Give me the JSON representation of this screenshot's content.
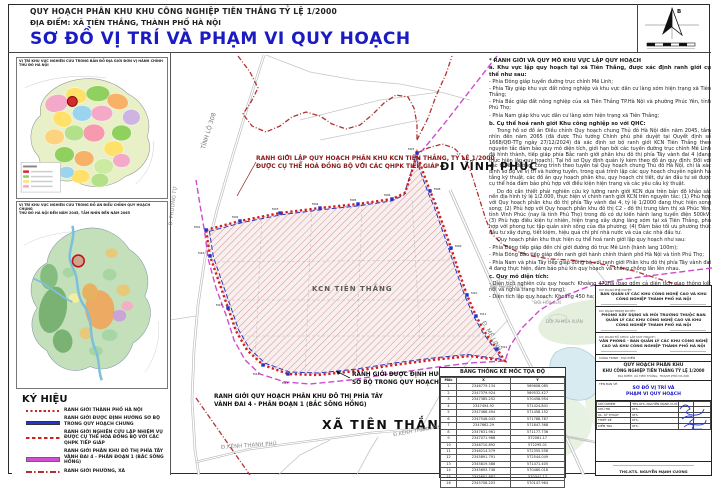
{
  "header": {
    "line1": "QUY HOẠCH PHÂN KHU KHU CÔNG NGHIỆP TIÊN THẮNG TỶ LỆ 1/2000",
    "line2": "ĐỊA ĐIỂM: XÃ TIÊN THẮNG, THÀNH PHỐ HÀ NỘI",
    "title": "SƠ ĐỒ VỊ TRÍ VÀ PHẠM VI QUY HOẠCH",
    "title_color": "#1b1bc4",
    "north_letter": "B"
  },
  "insets": {
    "map1_title_l1": "VỊ TRÍ KHU VỰC NGHIÊN CỨU TRONG BẢN ĐỒ ĐỊA GIỚI ĐƠN VỊ HÀNH CHÍNH",
    "map1_title_l2": "THỦ ĐÔ HÀ NỘI",
    "map2_title_l1": "VỊ TRÍ KHU VỰC NGHIÊN CỨU TRONG ĐỒ ÁN ĐIỀU CHỈNH QUY HOẠCH CHUNG",
    "map2_title_l2": "THỦ ĐÔ HÀ NỘI ĐẾN NĂM 2045, TẦM NHÌN ĐẾN NĂM 2065"
  },
  "legend": {
    "title": "KÝ HIỆU",
    "items": [
      {
        "label": "RANH GIỚI THÀNH PHỐ HÀ NỘI"
      },
      {
        "label": "RANH GIỚI ĐƯỢC ĐỊNH HƯỚNG SƠ BỘ TRONG QUY HOẠCH CHUNG"
      },
      {
        "label": "RANH GIỚI NGHIÊN CỨU LẬP NHIỆM VỤ ĐƯỢC CỤ THỂ HÓA ĐỒNG BỘ VỚI CÁC QHPK TIẾP GIÁP"
      },
      {
        "label": "RANH GIỚI PHÂN KHU ĐÔ THỊ PHÍA TÂY VÀNH ĐAI 4 - PHÂN ĐOẠN 1 (BẮC SÔNG HỒNG)"
      },
      {
        "label": "RANH GIỚI PHƯỜNG, XÃ"
      }
    ]
  },
  "map": {
    "site_label": "KCN TIÊN THẮNG",
    "labels": {
      "di_vinh_phuc": "ĐI VĨNH PHÚC",
      "xa_tien_thang": "XÃ TIÊN THẮNG",
      "tinh_lo_308": "TỈNH LỘ 308",
      "d_me_linh": "Đ. MÊ LINH",
      "d_kenh_thanh_phu": "Đ.KÊNH THANH PHÚ",
      "d_phuong_tu": "Đ. PHƯƠNG TỰ",
      "doi_thanh_tuoc": "ĐỒI THANH TƯỚC",
      "doi_hoa_sen": "ĐỒI HOA SEN",
      "doi_79_mua_xuan": "ĐỒI 79 MÙA XUÂN"
    },
    "callouts": {
      "lap_qh_l1": "RANH GIỚI LẬP QUY HOẠCH PHÂN KHU KCN TIÊN THẮNG, TỶ LỆ 1/2000",
      "lap_qh_l2": "ĐƯỢC CỤ THỂ HOÁ ĐỒNG BỘ VỚI CÁC QHPK TIẾP GIÁP",
      "dinh_huong_l1": "RANH GIỚI ĐƯỢC ĐỊNH HƯỚNG",
      "dinh_huong_l2": "SƠ BỘ TRONG QUY HOẠCH CHUNG",
      "vanh_dai_l1": "RANH GIỚI QUY HOẠCH PHÂN KHU ĐÔ THỊ PHÍA TÂY",
      "vanh_dai_l2": "VÀNH ĐAI 4 - PHÂN ĐOẠN 1 (BẮC SÔNG HỒNG)"
    },
    "markers": [
      "M01",
      "M02",
      "M03",
      "M04",
      "M05",
      "M06",
      "M07",
      "M08",
      "M09",
      "M10",
      "M11",
      "M12",
      "M13",
      "M14",
      "M15",
      "M16"
    ]
  },
  "notes": {
    "paragraphs": [
      "* RANH GIỚI VÀ QUY MÔ KHU VỰC LẬP QUY HOẠCH",
      "a. Khu vực lập quy hoạch tại xã Tiên Thắng, được xác định ranh giới cụ thể như sau:",
      "- Phía Đông giáp tuyến đường trục chính Mê Linh;",
      "- Phía Tây giáp khu vực đất nông nghiệp và khu vực dân cư làng xóm hiện trạng xã Tiên Thắng;",
      "- Phía Bắc giáp đất nông nghiệp của xã Tiên Thắng TP.Hà Nội và phường Phúc Yên, tỉnh Phú Thọ;",
      "- Phía Nam giáp khu vực dân cư làng xóm hiện trạng xã Tiên Thắng;",
      "b. Cụ thể hoá ranh giới Khu công nghiệp so với QHC:",
      "Trong hồ sơ đồ án Điều chỉnh Quy hoạch chung Thủ đô Hà Nội đến năm 2045, tầm nhìn đến năm 2065 (đã được Thủ tướng Chính phủ phê duyệt tại Quyết định số 1668/QĐ-TTg ngày 27/12/2024) đã xác định sơ bộ ranh giới KCN Tiên Thắng theo nguyên tắc đảm bảo quy mô diện tích, giới hạn bởi các tuyến đường trục chính Mê Linh đã hình thành, tiếp giáp phía Bắc ranh giới phân khu đô thị phía Tây vành đai 4 (đang thực hiện lập quy hoạch). Tại hồ sơ Quy định quản lý kèm theo đồ án quy định: Đối với các tuyến đường, công trình theo tuyến tại Quy hoạch chung Thủ đô Hà Nội, chỉ là xác định sơ bộ về vị trí và hướng tuyến, trong quá trình lập các quy hoạch chuyên ngành hạ tầng kỹ thuật, các đồ án quy hoạch phân khu, quy hoạch chi tiết, dự án đầu tư sẽ được cụ thể hóa đảm bảo phù hợp với điều kiện hiện trạng và các yêu cầu kỹ thuật.",
      "Do đó cần thiết phải nghiên cứu kỹ lưỡng ranh giới KCN dựa trên bản đồ khảo sát nền địa hình tỷ lệ 1/2.000, thực hiện vi chỉnh ranh giới KCN trên nguyên tắc: (1) Phù hợp với Quy hoạch phân khu đô thị phía Tây vành đai 4, tỷ lệ 1/2000 đang thực hiện song song; (2) Phù hợp với Quy hoạch phân khu đô thị C2 - đô thị trung tâm thị xã Phúc Yên, tỉnh Vĩnh Phúc (nay là tỉnh Phú Thọ) trong đó có dự kiến hành lang tuyến điện 500kV; (3) Phù hợp điều kiện tự nhiên, hiện trạng xây dựng làng xóm tại xã Tiên Thắng, phù hợp với phong tục tập quán sinh sống của địa phương; (4) Đảm bảo tối ưu phương thức đầu tư xây dựng, tiết kiệm, hiệu quả chi phí nhà nước và của các nhà đầu tư.",
      "Quy hoạch phân khu thực hiện cụ thể hoá ranh giới lập quy hoạch như sau:",
      "- Phía Đông tiếp giáp đến chỉ giới đường đỏ trục Mê Linh (hành lang 100m);",
      "- Phía Đông Bắc tiếp giáp đến ranh giới hành chính thành phố Hà Nội và tỉnh Phú Thọ;",
      "- Phía Nam và phía Tây tiếp giáp đồng bộ với ranh giới Phân khu đô thị phía Tây vành đai 4 đang thực hiện, đảm bảo phủ kín quy hoạch và không chồng lấn lên nhau.",
      "c. Quy mô diện tích:",
      "- Diện tích nghiên cứu quy hoạch: Khoảng 472ha (bao gồm cả diện tích giao thông kết nối và nghĩa trang hiện trạng);",
      "- Diện tích lập quy hoạch: Khoảng 450 ha;"
    ]
  },
  "coord_table": {
    "title": "BẢNG THỐNG KÊ MỐC TỌA ĐỘ",
    "columns": [
      "Mốc",
      "X",
      "Y"
    ],
    "rows": [
      [
        "1",
        "2346779.134",
        "569608.085"
      ],
      [
        "2",
        "2347379.924",
        "569532.427"
      ],
      [
        "3",
        "2347385.252",
        "570458.954"
      ],
      [
        "4",
        "2347494.92",
        "571424.841"
      ],
      [
        "5",
        "2347468.494",
        "571458.152"
      ],
      [
        "6",
        "2347548.043",
        "571788.787"
      ],
      [
        "7",
        "2347662.29",
        "571847.368"
      ],
      [
        "8",
        "2347631.961",
        "571177.736"
      ],
      [
        "9",
        "2347071.968",
        "572061.17"
      ],
      [
        "10",
        "2346710.892",
        "572295.01"
      ],
      [
        "11",
        "2346214.579",
        "572355.558"
      ],
      [
        "12",
        "2345891.791",
        "572544.049"
      ],
      [
        "13",
        "2345819.588",
        "571471.405"
      ],
      [
        "14",
        "2345693.748",
        "570460.016"
      ],
      [
        "15",
        "2345651.887",
        "570341.17"
      ],
      [
        "16",
        "2345708.203",
        "570147.964"
      ]
    ]
  },
  "title_block": {
    "sec1_label": "CƠ QUAN PHÊ DUYỆT:",
    "sec1_body": "BAN QUẢN LÝ CÁC KHU CÔNG NGHỆ CAO VÀ KHU CÔNG NGHIỆP THÀNH PHỐ HÀ NỘI",
    "sec2_label": "CƠ QUAN TRÌNH DUYỆT:",
    "sec2_body": "PHÒNG XÂY DỰNG VÀ MÔI TRƯỜNG THUỘC BAN QUẢN LÝ CÁC KHU CÔNG NGHỆ CAO VÀ KHU CÔNG NGHIỆP THÀNH PHỐ HÀ NỘI",
    "sec3_label": "CƠ QUAN TỔ CHỨC LẬP QUY HOẠCH:",
    "sec3_body": "VĂN PHÒNG - BAN QUẢN LÝ CÁC KHU CÔNG NGHỆ CAO VÀ KHU CÔNG NGHIỆP THÀNH PHỐ HÀ NỘI",
    "project_label": "CÔNG TRÌNH - ĐỊA ĐIỂM",
    "project_l1": "QUY HOẠCH PHÂN KHU",
    "project_l2": "KHU CÔNG NGHIỆP TIÊN THẮNG TỶ LỆ 1/2000",
    "project_loc": "ĐỊA ĐIỂM: XÃ TIÊN THẮNG, THÀNH PHỐ HÀ NỘI",
    "drawing_label": "TÊN BẢN VẼ:",
    "drawing_l1": "SƠ ĐỒ VỊ TRÍ VÀ",
    "drawing_l2": "PHẠM VI QUY HOẠCH",
    "sig_rows": [
      [
        "CHỦ NHIỆM",
        "THS.KTS. NGUYỄN MẠNH CƯỜNG",
        "",
        ""
      ],
      [
        "CHỦ TRÌ",
        "KTS.",
        "",
        ""
      ],
      [
        "QL. KỸ THUẬT",
        "KTS.",
        "",
        ""
      ],
      [
        "THIẾT KẾ",
        "KTS.",
        "",
        ""
      ],
      [
        "KIỂM TRA",
        "KTS.",
        "",
        ""
      ]
    ],
    "approver_name": "THS.KTS. NGUYỄN MẠNH CƯỜNG"
  }
}
